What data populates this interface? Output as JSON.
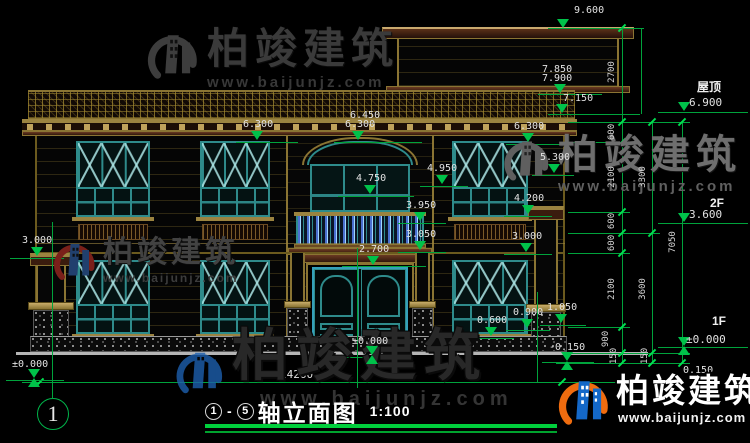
{
  "brand": {
    "name": "柏竣建筑",
    "url": "www.baijunjz.com"
  },
  "title_block": {
    "axis_from": "1",
    "sep": "-",
    "axis_to": "5",
    "title": "轴立面图",
    "scale": "1:100",
    "axis_bubble": "1"
  },
  "levels": [
    {
      "label": "屋顶",
      "elev": "6.900",
      "tx": 697,
      "ty": 78,
      "ex": 689,
      "ey": 96,
      "mx": 678,
      "my": 102,
      "lx": 658,
      "ly": 112,
      "lw": 90,
      "pm": false
    },
    {
      "label": "2F",
      "elev": "3.600",
      "tx": 710,
      "ty": 196,
      "ex": 689,
      "ey": 208,
      "mx": 678,
      "my": 213,
      "lx": 658,
      "ly": 223,
      "lw": 90,
      "pm": false
    },
    {
      "label": "1F",
      "elev": "±0.000",
      "tx": 712,
      "ty": 314,
      "ex": 686,
      "ey": 333,
      "mx": 678,
      "my": 337,
      "lx": 658,
      "ly": 347,
      "lw": 90,
      "pm": true
    }
  ],
  "overall_width": "14260",
  "elevation_marks": [
    {
      "v": "9.600",
      "x": 574,
      "y": 5,
      "m": "tri",
      "mx": 557,
      "my": 19,
      "lx": 548,
      "ly": 28,
      "lw": 96
    },
    {
      "v": "7.850",
      "x": 542,
      "y": 64,
      "m": "none"
    },
    {
      "v": "7.900",
      "x": 542,
      "y": 73,
      "m": "tri",
      "mx": 554,
      "my": 84,
      "lx": 538,
      "ly": 94,
      "lw": 64
    },
    {
      "v": "7.150",
      "x": 563,
      "y": 93,
      "m": "tri",
      "mx": 556,
      "my": 104,
      "lx": 548,
      "ly": 114,
      "lw": 92
    },
    {
      "v": "6.450",
      "x": 350,
      "y": 110,
      "m": "none"
    },
    {
      "v": "6.300",
      "x": 345,
      "y": 119,
      "m": "tri",
      "mx": 352,
      "my": 131,
      "lx": 334,
      "ly": 142,
      "lw": 88
    },
    {
      "v": "6.300",
      "x": 243,
      "y": 119,
      "m": "tri",
      "mx": 251,
      "my": 131,
      "lx": 236,
      "ly": 142,
      "lw": 62
    },
    {
      "v": "6.300",
      "x": 514,
      "y": 121,
      "m": "tri",
      "mx": 522,
      "my": 133,
      "lx": 506,
      "ly": 144,
      "lw": 64
    },
    {
      "v": "5.300",
      "x": 540,
      "y": 152,
      "m": "tri",
      "mx": 548,
      "my": 164,
      "lx": 532,
      "ly": 175,
      "lw": 42
    },
    {
      "v": "4.950",
      "x": 427,
      "y": 163,
      "m": "tri",
      "mx": 436,
      "my": 175,
      "lx": 420,
      "ly": 186,
      "lw": 48
    },
    {
      "v": "4.750",
      "x": 356,
      "y": 173,
      "m": "tri",
      "mx": 364,
      "my": 185,
      "lx": 338,
      "ly": 196,
      "lw": 76
    },
    {
      "v": "4.200",
      "x": 514,
      "y": 193,
      "m": "tri",
      "mx": 522,
      "my": 205,
      "lx": 504,
      "ly": 216,
      "lw": 48
    },
    {
      "v": "3.950",
      "x": 406,
      "y": 200,
      "m": "tri",
      "mx": 414,
      "my": 212,
      "lx": 398,
      "ly": 223,
      "lw": 48
    },
    {
      "v": "3.050",
      "x": 406,
      "y": 229,
      "m": "tri",
      "mx": 414,
      "my": 241,
      "lx": 398,
      "ly": 252,
      "lw": 48
    },
    {
      "v": "2.700",
      "x": 359,
      "y": 244,
      "m": "tri",
      "mx": 367,
      "my": 256,
      "lx": 342,
      "ly": 266,
      "lw": 84
    },
    {
      "v": "3.000",
      "x": 22,
      "y": 235,
      "m": "tri",
      "mx": 31,
      "my": 247,
      "lx": 10,
      "ly": 258,
      "lw": 54
    },
    {
      "v": "3.000",
      "x": 512,
      "y": 231,
      "m": "tri",
      "mx": 520,
      "my": 243,
      "lx": 504,
      "ly": 254,
      "lw": 48
    },
    {
      "v": "1.050",
      "x": 547,
      "y": 302,
      "m": "tri",
      "mx": 555,
      "my": 314,
      "lx": 540,
      "ly": 325,
      "lw": 46
    },
    {
      "v": "0.900",
      "x": 513,
      "y": 307,
      "m": "tri",
      "mx": 521,
      "my": 319,
      "lx": 506,
      "ly": 330,
      "lw": 44
    },
    {
      "v": "0.600",
      "x": 477,
      "y": 315,
      "m": "tri",
      "mx": 485,
      "my": 327,
      "lx": 470,
      "ly": 338,
      "lw": 44
    },
    {
      "v": "±0.000",
      "x": 12,
      "y": 359,
      "m": "pm",
      "mx": 28,
      "my": 369,
      "lx": 6,
      "ly": 380,
      "lw": 58
    },
    {
      "v": "±0.000",
      "x": 352,
      "y": 336,
      "m": "pm",
      "mx": 366,
      "my": 346,
      "lx": 342,
      "ly": 357,
      "lw": 58
    },
    {
      "v": "-0.150",
      "x": 549,
      "y": 342,
      "m": "pm",
      "mx": 561,
      "my": 352,
      "lx": 542,
      "ly": 362,
      "lw": 52
    },
    {
      "v": "0.150",
      "x": 683,
      "y": 365,
      "m": "none"
    }
  ],
  "chain_dims": [
    {
      "v": "2700",
      "x": 612,
      "y": 72
    },
    {
      "v": "600",
      "x": 612,
      "y": 132
    },
    {
      "v": "2100",
      "x": 612,
      "y": 177
    },
    {
      "v": "600",
      "x": 612,
      "y": 221
    },
    {
      "v": "600",
      "x": 612,
      "y": 243
    },
    {
      "v": "2100",
      "x": 612,
      "y": 289
    },
    {
      "v": "900",
      "x": 606,
      "y": 339
    },
    {
      "v": "150",
      "x": 614,
      "y": 356
    },
    {
      "v": "3300",
      "x": 643,
      "y": 177
    },
    {
      "v": "3600",
      "x": 643,
      "y": 289
    },
    {
      "v": "150",
      "x": 645,
      "y": 356
    },
    {
      "v": "7050",
      "x": 673,
      "y": 242
    }
  ],
  "colors": {
    "dim_green": "#00a33c",
    "tick_green": "#00e050",
    "frame_teal": "#2e8b8b",
    "wood_olive": "#8a7433",
    "logo_blue": "#1468c8",
    "logo_orange": "#ef6c0f"
  }
}
